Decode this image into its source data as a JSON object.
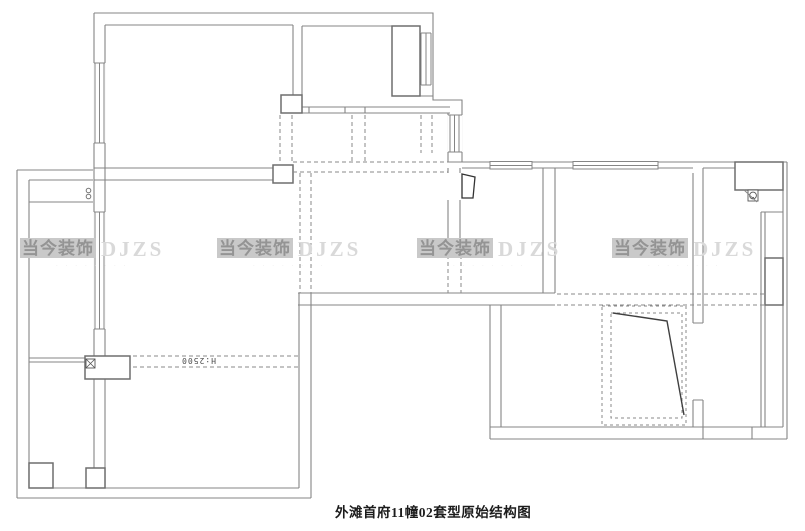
{
  "plan": {
    "caption": "外滩首府11幢02套型原始结构图",
    "height_annotation": "H:2500"
  },
  "watermark": {
    "brand_cn": "当今装饰",
    "brand_en": "DJZS",
    "subtext": "· · · · · · · ·"
  },
  "colors": {
    "wall_line": "#858585",
    "block_line": "#6e6e6e",
    "dashed_line": "#8a8a8a",
    "dark_detail": "#3f3f3f",
    "watermark_box": "#c9c9c9",
    "watermark_cn": "#949494",
    "watermark_en": "#d9d9d9",
    "caption_text": "#1c1c1c"
  }
}
